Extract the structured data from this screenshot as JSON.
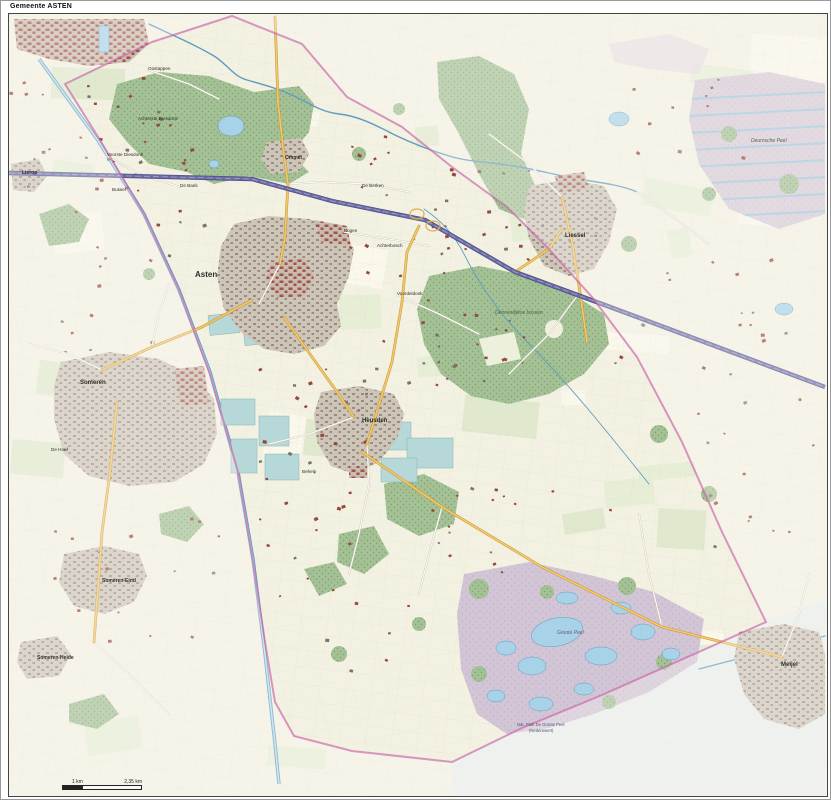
{
  "title": "Gemeente ASTEN",
  "scalebar": {
    "mid_label": "1 km",
    "end_label": "2,35 km"
  },
  "palette": {
    "base": "#f3f1e2",
    "pasture": "#e3edd3",
    "crop": "#faf8ec",
    "pasture2": "#dce8c9",
    "forest": "#a3c195",
    "forestDot": "#7d9f6e",
    "heath": "#d2c5d5",
    "heathDot": "#bba9c2",
    "heathPale": "#e7edea",
    "water": "#a8d2e7",
    "waterLine": "#5f9cc0",
    "urbanBase": "#cdc5b8",
    "urbanBldg": "#9a8d80",
    "urbanBase2": "#c9bcae",
    "urbanRed": "#a0534a",
    "greenhouse": "#b7d8d8",
    "motorway": "#6b6ba6",
    "mainRoad": "#f3c968",
    "mainRoadCasing": "#c3913a",
    "minorRoad": "#ffffff",
    "minorCasing": "#c9c2ae",
    "boundary": "#c863a8",
    "labelDark": "#2e2e2a"
  },
  "map": {
    "labels": [
      {
        "id": "asten",
        "text": "Asten",
        "x": 186,
        "y": 263,
        "cls": "town big"
      },
      {
        "id": "someren",
        "text": "Someren",
        "x": 71,
        "y": 370,
        "cls": "town"
      },
      {
        "id": "liessel",
        "text": "Liessel",
        "x": 556,
        "y": 223,
        "cls": "town"
      },
      {
        "id": "meijel",
        "text": "Meijel",
        "x": 772,
        "y": 652,
        "cls": "town"
      },
      {
        "id": "heusden",
        "text": "Heusden",
        "x": 353,
        "y": 408,
        "cls": "town"
      },
      {
        "id": "ommel",
        "text": "Ommel",
        "x": 276,
        "y": 145,
        "cls": "town sm"
      },
      {
        "id": "someren-eind",
        "text": "Someren-Eind",
        "x": 93,
        "y": 568,
        "cls": "town sm"
      },
      {
        "id": "someren-heide",
        "text": "Someren-Heide",
        "x": 28,
        "y": 645,
        "cls": "town sm"
      },
      {
        "id": "lierop",
        "text": "Lierop",
        "x": 13,
        "y": 160,
        "cls": "town sm"
      },
      {
        "id": "oostappen",
        "text": "Oostappen",
        "x": 139,
        "y": 56,
        "cls": "hamlet"
      },
      {
        "id": "achterste-diesdonk",
        "text": "Achterste Diesdonk",
        "x": 129,
        "y": 106,
        "cls": "hamlet"
      },
      {
        "id": "voorste-diesdonk",
        "text": "Voorste Diesdonk",
        "x": 98,
        "y": 142,
        "cls": "hamlet"
      },
      {
        "id": "bussel",
        "text": "Bussel",
        "x": 103,
        "y": 177,
        "cls": "hamlet"
      },
      {
        "id": "de-bank",
        "text": "De Bank",
        "x": 171,
        "y": 173,
        "cls": "hamlet"
      },
      {
        "id": "de-berken",
        "text": "De Berken",
        "x": 353,
        "y": 173,
        "cls": "hamlet"
      },
      {
        "id": "bogen",
        "text": "Bogen",
        "x": 335,
        "y": 218,
        "cls": "hamlet"
      },
      {
        "id": "achterbosch",
        "text": "Achterbosch",
        "x": 368,
        "y": 233,
        "cls": "hamlet"
      },
      {
        "id": "voordeldonk",
        "text": "Voordeldonk",
        "x": 388,
        "y": 281,
        "cls": "hamlet"
      },
      {
        "id": "behelp",
        "text": "Behelp",
        "x": 293,
        "y": 459,
        "cls": "hamlet"
      },
      {
        "id": "de-hoef",
        "text": "De Hoef",
        "x": 42,
        "y": 437,
        "cls": "hamlet"
      },
      {
        "id": "dennendijkse-bossen",
        "text": "Dennendijkse bossen",
        "x": 486,
        "y": 300,
        "cls": "area"
      },
      {
        "id": "deurnsche-peel",
        "text": "Deurnsche Peel",
        "x": 742,
        "y": 128,
        "cls": "area"
      },
      {
        "id": "groote-peel",
        "text": "Groote Peel",
        "x": 548,
        "y": 620,
        "cls": "area heathlbl"
      },
      {
        "id": "natpark-line1",
        "text": "Nat. Park De Groote Peel",
        "x": 508,
        "y": 712,
        "cls": "park"
      },
      {
        "id": "natpark-line2",
        "text": "(Nederweert)",
        "x": 520,
        "y": 718,
        "cls": "park"
      }
    ]
  }
}
